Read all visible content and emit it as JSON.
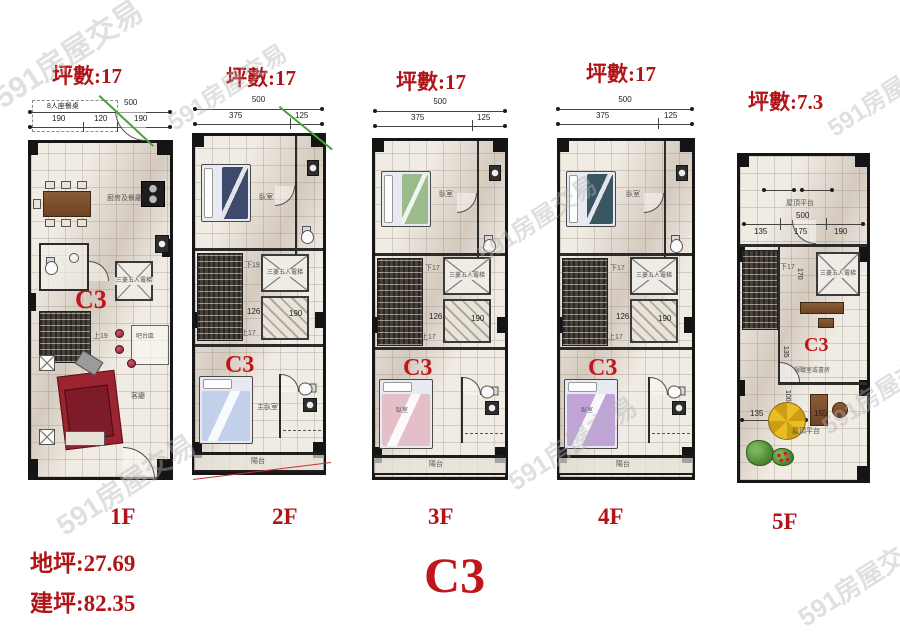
{
  "watermark": "591房屋交易",
  "headers": {
    "f1_area": "坪數:17",
    "f2_area": "坪數:17",
    "f3_area": "坪數:17",
    "f4_area": "坪數:17",
    "f5_area": "坪數:7.3"
  },
  "floors": [
    "1F",
    "2F",
    "3F",
    "4F",
    "5F"
  ],
  "footer": {
    "land_area": "地坪:27.69",
    "built_area": "建坪:82.35",
    "unit_code": "C3"
  },
  "plan1": {
    "unit": "C3",
    "dim_table": "8人座餐桌",
    "dim_total": "500",
    "dim_a": "190",
    "dim_b": "120",
    "dim_c": "190",
    "kitchen_dining": "廚房及餐廳",
    "elevator": "三菱五人電梯",
    "stair_up": "上19",
    "bar_area": "吧台區",
    "living": "客廳"
  },
  "plan2": {
    "unit": "C3",
    "dim_total": "500",
    "dim_a": "375",
    "dim_b": "125",
    "bedroom": "臥室",
    "stair_down": "下19",
    "elevator": "三菱五人電梯",
    "dim_c": "126",
    "dim_d": "190",
    "stair_up": "上17",
    "master_bedroom": "主臥室",
    "balcony": "陽台"
  },
  "plan3": {
    "unit": "C3",
    "dim_total": "500",
    "dim_a": "375",
    "dim_b": "125",
    "bedroom_top": "臥室",
    "stair_down": "下17",
    "elevator": "三菱五人電梯",
    "dim_c": "126",
    "dim_d": "190",
    "stair_up": "上17",
    "bedroom_bottom": "臥室",
    "balcony": "陽台"
  },
  "plan4": {
    "unit": "C3",
    "dim_total": "500",
    "dim_a": "375",
    "dim_b": "125",
    "bedroom_top": "臥室",
    "stair_down": "下17",
    "elevator": "三菱五人電梯",
    "dim_c": "126",
    "dim_d": "190",
    "stair_up": "上17",
    "bedroom_bottom": "臥室",
    "balcony": "陽台"
  },
  "plan5": {
    "unit": "C3",
    "roof_deck_top": "屋頂平台",
    "dim_total": "500",
    "dim_a": "135",
    "dim_b": "175",
    "dim_c": "190",
    "stair_down": "下17",
    "elevator": "三菱五人電梯",
    "dim_v1": "170",
    "room": "視聽室或書房",
    "dim_v2": "135",
    "dim_v3": "100",
    "dim_e": "135",
    "dim_f": "155",
    "roof_deck_bottom": "屋頂平台"
  }
}
